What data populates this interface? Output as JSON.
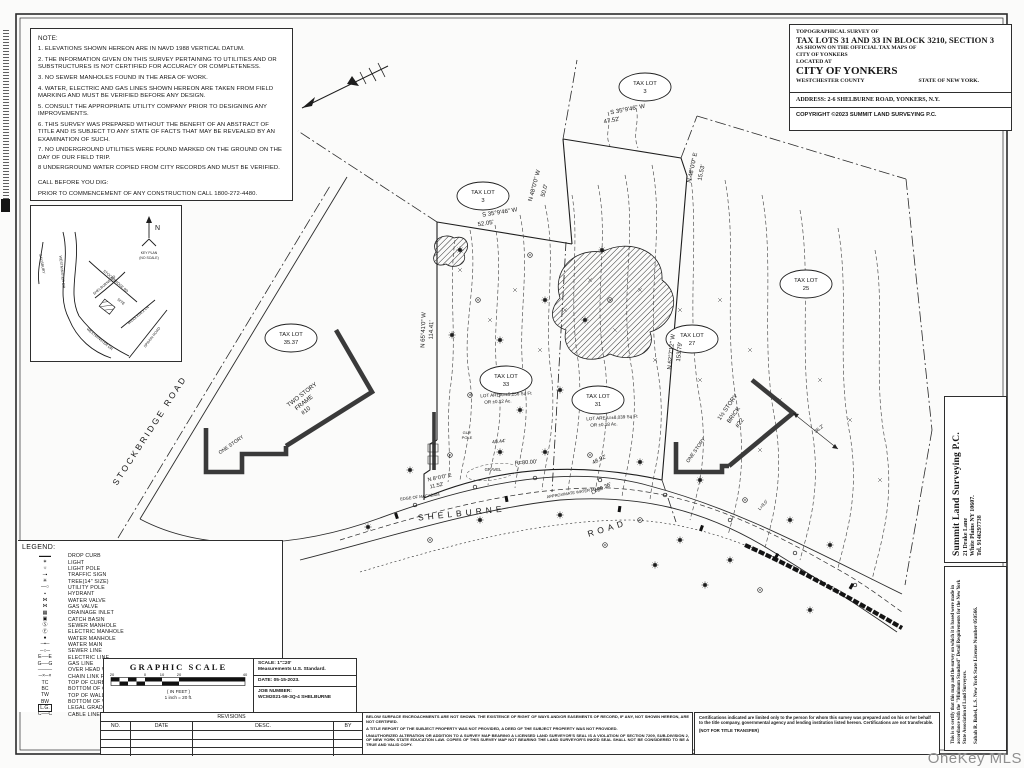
{
  "page": {
    "watermark": "OneKey MLS"
  },
  "notes": {
    "title": "NOTE:",
    "items": [
      "1.  ELEVATIONS SHOWN HEREON ARE IN NAVD 1988 VERTICAL DATUM.",
      "2.  THE INFORMATION GIVEN ON THIS SURVEY PERTAINING TO UTILITIES AND OR SUBSTRUCTURES IS NOT CERTIFIED FOR ACCURACY OR COMPLETENESS.",
      "3.  NO SEWER MANHOLES FOUND IN THE AREA OF WORK.",
      "4.  WATER, ELECTRIC AND GAS LINES SHOWN HEREON ARE TAKEN FROM FIELD MARKING AND MUST BE VERIFIED BEFORE ANY DESIGN.",
      "5.  CONSULT THE APPROPRIATE UTILITY COMPANY PRIOR TO DESIGNING ANY IMPROVEMENTS.",
      "6.  THIS SURVEY WAS PREPARED WITHOUT THE BENEFIT OF AN ABSTRACT OF TITLE AND IS SUBJECT TO ANY STATE OF FACTS THAT MAY BE REVEALED BY AN EXAMINATION OF SUCH.",
      "7.  NO UNDERGROUND UTILITIES WERE FOUND MARKED ON THE GROUND ON THE DAY OF OUR FIELD TRIP.",
      "8   UNDERGROUND WATER COPIED FROM CITY RECORDS AND MUST BE VERIFIED."
    ],
    "call_title": "CALL BEFORE YOU DIG:",
    "call_text": "PRIOR TO COMMENCEMENT OF ANY CONSTRUCTION CALL 1800-272-4480."
  },
  "title_block": {
    "l1": "TOPOGRAPHICAL SURVEY OF",
    "l2": "TAX LOTS 31 AND 33 IN BLOCK 3210, SECTION 3",
    "l3": "AS SHOWN ON THE OFFICIAL TAX MAPS OF",
    "l4": "CITY OF YONKERS",
    "l5": "LOCATED AT",
    "l6": "CITY OF YONKERS",
    "l7a": "WESTCHESTER  COUNTY",
    "l7b": "STATE OF NEW YORK.",
    "address": "ADDRESS: 2-6 SHELBURNE ROAD, YONKERS, N.Y.",
    "copyright": "COPYRIGHT ©2023 SUMMIT LAND SURVEYING P.C."
  },
  "key_plan": {
    "north": "N",
    "caption1": "KEY PLAN",
    "caption2": "(NO SCALE)",
    "site": "SITE",
    "r1": "SALISBURY",
    "r2": "WESTMINSTER DR",
    "r3": "STOCKBRIDGE RD",
    "r4": "SHELBURNE RD",
    "r5": "MIDDLESEX LN",
    "r6": "SPRAIN ROAD",
    "r7": "WESTMINSTER DR"
  },
  "legend": {
    "title": "LEGEND:",
    "items": [
      {
        "sym": "drop-curb",
        "label": "DROP CURB"
      },
      {
        "sym": "light",
        "label": "LIGHT"
      },
      {
        "sym": "light-pole",
        "label": "LIGHT POLE"
      },
      {
        "sym": "traffic-sign",
        "label": "TRAFFIC SIGN"
      },
      {
        "sym": "tree",
        "label": "TREE(14\" SIZE)"
      },
      {
        "sym": "utility-pole",
        "label": "UTILITY POLE"
      },
      {
        "sym": "hydrant",
        "label": "HYDRANT"
      },
      {
        "sym": "water-valve",
        "label": "WATER VALVE"
      },
      {
        "sym": "gas-valve",
        "label": "GAS VALVE"
      },
      {
        "sym": "drainage-inlet",
        "label": "DRAINAGE INLET"
      },
      {
        "sym": "catch-basin",
        "label": "CATCH BASIN"
      },
      {
        "sym": "sewer-manhole",
        "label": "SEWER MANHOLE"
      },
      {
        "sym": "electric-manhole",
        "label": "ELECTRIC MANHOLE"
      },
      {
        "sym": "water-manhole",
        "label": "WATER MANHOLE"
      },
      {
        "sym": "water-main",
        "label": "WATER MAIN"
      },
      {
        "sym": "sewer-line",
        "label": "SEWER LINE"
      },
      {
        "sym": "electric-line",
        "label": "ELECTRIC LINE"
      },
      {
        "sym": "gas-line",
        "label": "GAS LINE"
      },
      {
        "sym": "ohw",
        "label": "OVER HEAD WIRES"
      },
      {
        "sym": "clf",
        "label": "CHAIN LINK FENCE"
      },
      {
        "sym": "tc",
        "label": "TOP OF CURB"
      },
      {
        "sym": "bc",
        "label": "BOTTOM OF CURB"
      },
      {
        "sym": "tw",
        "label": "TOP OF WALL"
      },
      {
        "sym": "bw",
        "label": "BOTTOM OF WALL"
      },
      {
        "sym": "lg",
        "label": "LEGAL GRADE"
      },
      {
        "sym": "cable",
        "label": "CABLE LINE"
      }
    ]
  },
  "graphic_scale": {
    "title": "GRAPHIC SCALE",
    "ticks": {
      "a": "20",
      "b": "0",
      "c": "10",
      "d": "20",
      "e": "40"
    },
    "in_feet": "( IN FEET )",
    "ratio": "1 inch = 20  ft."
  },
  "scale_info": {
    "scale": "SCALE:  1\"=20'",
    "std": "Measurements U.S. Standard.",
    "date": "DATE: 05-15-2023.",
    "job_label": "JOB NUMBER:",
    "job": "WCM2021-59-3Q-4 SHELBURNE"
  },
  "revisions": {
    "title": "REVISIONS",
    "cols": [
      "NO.",
      "DATE",
      "DESC.",
      "BY"
    ]
  },
  "disclaimer": {
    "p1": "BELOW SURFACE ENCROACHMENTS ARE NOT SHOWN. THE EXISTENCE OF RIGHT OF WAYS AND/OR EASEMENTS OF RECORD, IF ANY, NOT SHOWN HEREON, ARE NOT CERTIFIED.",
    "p2": "A TITLE REPORT OF THE SUBJECT PROPERTY WAS NOT PROVIDED, A DEED OF THE SUBJECT PROPERTY WAS NOT PROVIDED.",
    "p3": "UNAUTHORIZED ALTERATION OR ADDITION TO A SURVEY MAP BEARING A LICENSED LAND SURVEYOR'S SEAL IS A VIOLATION OF SECTION 7209, SUB-DIVISION 2, OF NEW YORK STATE EDUCATION LAW. COPIES OF THIS SURVEY MAP NOT BEARING THE LAND SURVEYOR'S INKED SEAL SHALL NOT BE CONSIDERED TO BE A TRUE AND VALID COPY."
  },
  "certification": {
    "p1": "Certifications indicated are limited only to the person for whom this survey was prepared and on his or her behalf to the title company, governmental agency and lending institution listed hereon. Certifications are not transferable.",
    "p2": "(NOT FOR TITLE TRANSFER)"
  },
  "company": {
    "name": "Summit Land Surveying P.C.",
    "addr1": "21 Drake Lane",
    "addr2": "White Plains NY 10607.",
    "tel": "Tel. 9146297738"
  },
  "certify": {
    "text": "This is to certify that this map and the survey on which it is based were made in accordance with the \"Minimum Standard\" Detail Requirements for the New York State Association of Land Surveyors.",
    "license": "Sabah R. Babel, L.S. New York State License Number 050566."
  },
  "survey": {
    "tax_lot_label": "TAX LOT",
    "lots": {
      "a": "3",
      "b": "3",
      "c": "25",
      "d": "27",
      "e": "31",
      "f": "33",
      "g": "35.37"
    },
    "areas": {
      "lot33a": "LOT AREA=±5,256 Sq Ft",
      "lot33b": "OR ±0.12 Ac.",
      "lot31a": "LOT AREA=±8,039 Sq Ft",
      "lot31b": "OR ±0.18 Ac."
    },
    "bearings": {
      "t1a": "S 35°9'46\" W",
      "t1b": "47.52'",
      "t2a": "S 35°9'46\" W",
      "t2b": "52.05'",
      "left_a": "N 65°41'0\" W",
      "left_b": "114.41'",
      "n48w_a": "N 48°0'0\" W",
      "n48w_b": "50.0'",
      "n48e_a": "N 48°0'0\" E",
      "n48e_b": "15.53'",
      "right_a": "N 62°7'12\" W",
      "right_b": "153.79'",
      "bot_a": "N 8°0'0\" E",
      "bot_b": "11.52'"
    },
    "dims": {
      "r80": "R=80.00'",
      "l89": "L=89.36'",
      "c4892": "48.92'",
      "l8": "L=8.0'",
      "c4044": "40.44'",
      "c362": "36.2'"
    },
    "roads": {
      "stockbridge": "STOCKBRIDGE ROAD",
      "shelburne": "SHELBURNE",
      "road": "ROAD"
    },
    "anno": {
      "gravel": "GRAVEL",
      "eom": "EDGE OF MACADAM",
      "awm": "APPROXIMATE WATER MAIN",
      "guy1": "GUY",
      "guy2": "POLE"
    },
    "buildings": {
      "b10l1": "TWO STORY",
      "b10l2": "FRAME",
      "b10l3": "#10",
      "b10one": "ONE STORY",
      "b22l1": "1½ STORY",
      "b22l2": "BRICK",
      "b22l3": "#22",
      "b22one": "ONE STORY"
    }
  }
}
